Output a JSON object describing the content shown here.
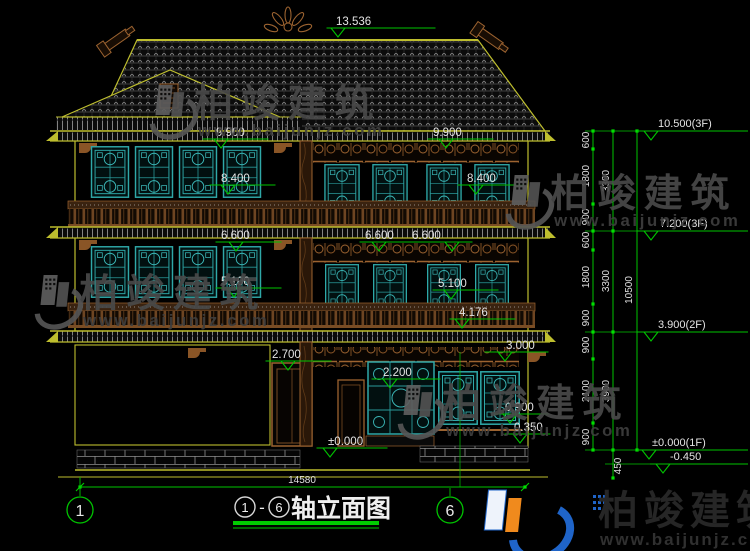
{
  "watermark": {
    "brand": "柏竣建筑",
    "url": "www.baijunjz.com"
  },
  "footer_logo": {
    "brand": "柏竣建筑",
    "url": "www.baijunjz.com"
  },
  "title_block": {
    "axis_start": "1",
    "separator": "-",
    "axis_end": "6",
    "name": "轴立面图"
  },
  "axes": {
    "left": "1",
    "right": "6"
  },
  "overall_width": "14580",
  "facade_levels": {
    "ridge": "13.536",
    "roof3f_left": "9.900",
    "roof3f_right": "9.900",
    "lintel3f_left": "8.400",
    "lintel3f_right": "8.400",
    "eave2f_left": "6.600",
    "eave2f_mid": "6.600",
    "eave2f_right": "6.600",
    "lintel2f_left": "5.100",
    "lintel2f_right": "5.100",
    "rail2f": "4.176",
    "eave1f": "3.000",
    "door1f": "2.700",
    "window1f": "2.200",
    "sill1f": "0.900",
    "plinth": "0.350",
    "ground": "±0.000"
  },
  "right_dims": {
    "segments": [
      "600",
      "1800",
      "900",
      "600",
      "1800",
      "900",
      "900",
      "2100",
      "900"
    ],
    "subtotals": [
      "3300",
      "3300",
      "3900"
    ],
    "total": "10500",
    "foundation": "450",
    "levels": [
      "10.500(3F)",
      "7.200(3F)",
      "3.900(2F)",
      "±0.000(1F)",
      "-0.450"
    ]
  },
  "colors": {
    "line_yellow": "#bebe2e",
    "dim_green": "#00c400",
    "window_teal": "#2fa8a8",
    "wood_brown": "#9c6330",
    "text_white": "#e4e4e4",
    "watermark_gray": "#4a4a4a",
    "logo_blue": "#1f64c8",
    "logo_orange": "#f08a1d"
  }
}
